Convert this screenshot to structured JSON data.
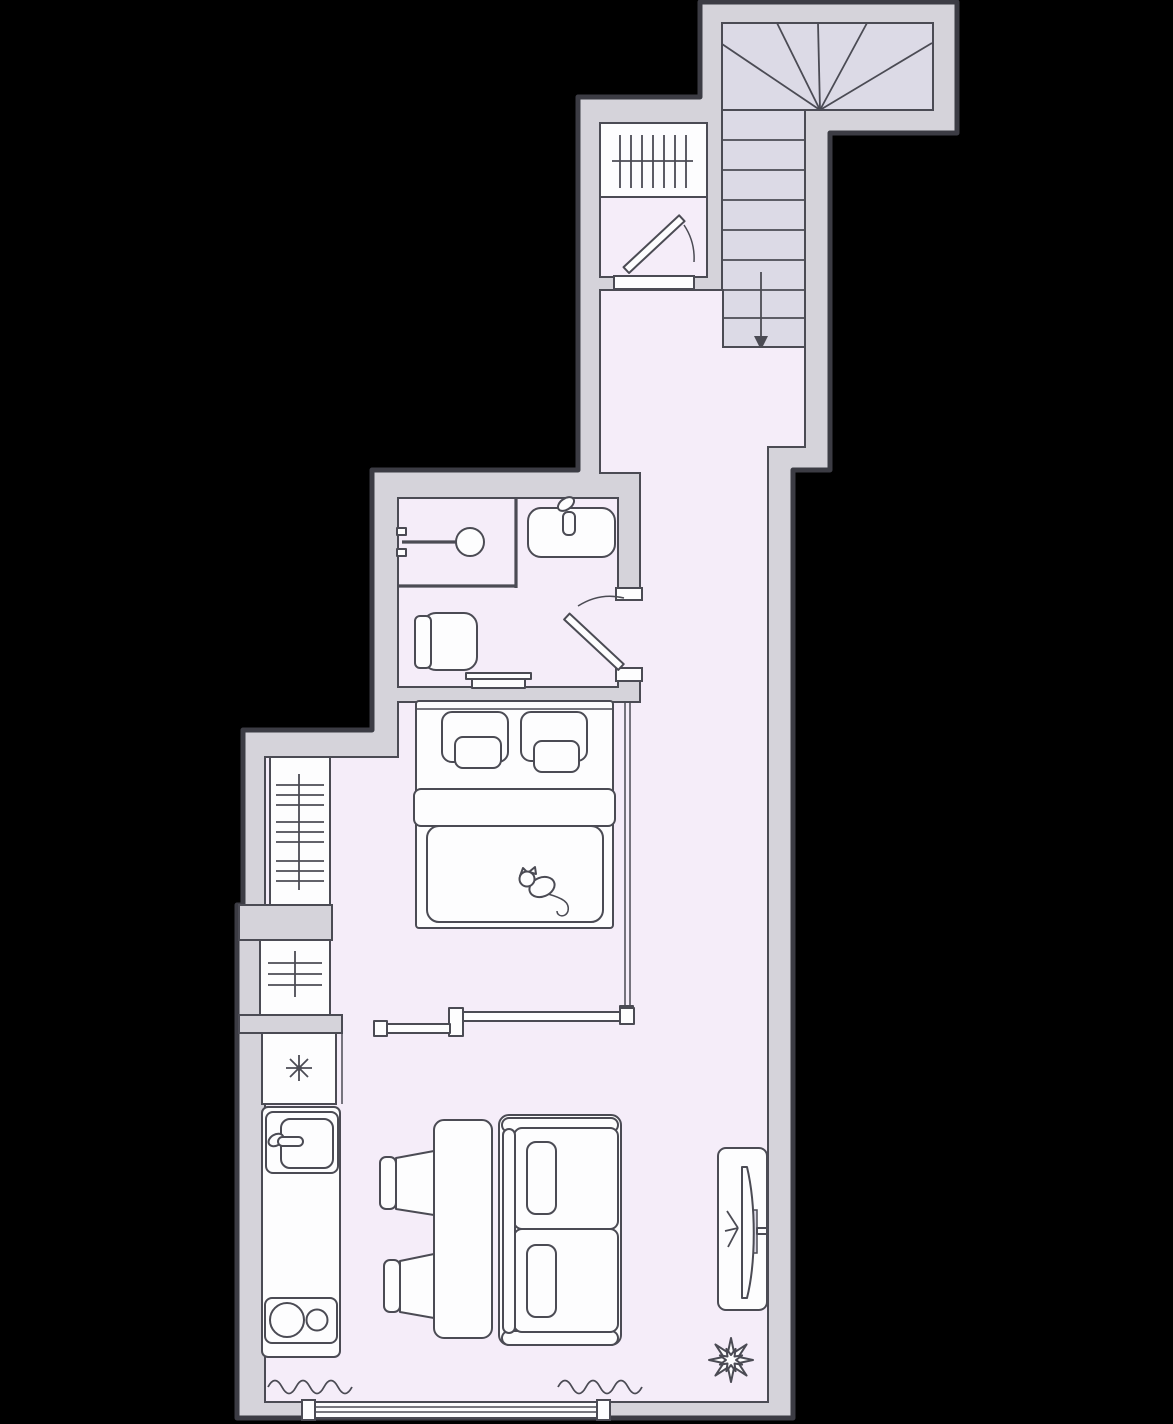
{
  "colors": {
    "bg": "#000000",
    "wall": "#d5d3da",
    "outline": "#3c3c44",
    "line": "#4b4b54",
    "floor": "#f5edf9",
    "stair": "#dcdae6",
    "paper": "#fdfdfe"
  },
  "plan": {
    "type": "studio-apartment-floor-plan",
    "rooms": [
      {
        "id": "staircase",
        "label": "staircase",
        "features": [
          "winder-treads",
          "straight-flight",
          "down-arrow"
        ]
      },
      {
        "id": "entry-vestibule",
        "label": "entry vestibule",
        "features": [
          "entry-door-swing",
          "hatched-wardrobe",
          "threshold"
        ]
      },
      {
        "id": "hallway",
        "label": "hallway",
        "features": []
      },
      {
        "id": "bathroom",
        "label": "bathroom",
        "features": [
          "shower",
          "washbasin",
          "toilet",
          "bath-bench",
          "door-swing"
        ]
      },
      {
        "id": "sleeping-area",
        "label": "sleeping area",
        "features": [
          "double-bed",
          "pillows",
          "cat-on-bed",
          "glass-partition",
          "sliding-door"
        ]
      },
      {
        "id": "kitchen",
        "label": "kitchen",
        "features": [
          "fridge-snowflake",
          "kitchen-sink",
          "two-burner-cooktop",
          "counter"
        ]
      },
      {
        "id": "living-area",
        "label": "living area",
        "features": [
          "dining-table",
          "two-chairs",
          "two-seat-sofa",
          "tv-on-stand",
          "plant",
          "panoramic-window",
          "curtains"
        ]
      }
    ],
    "stairs": {
      "straight_treads": 8,
      "winder_treads": 6,
      "direction": "down"
    },
    "radiator_count": 2,
    "curtain_count": 2,
    "cooktop_burners": 2,
    "symbols": {
      "fridge": "asterisk-snowflake",
      "radiator": "hatched-white-box",
      "curtain": "wavy-line",
      "window": "triple-line-glazing"
    }
  }
}
